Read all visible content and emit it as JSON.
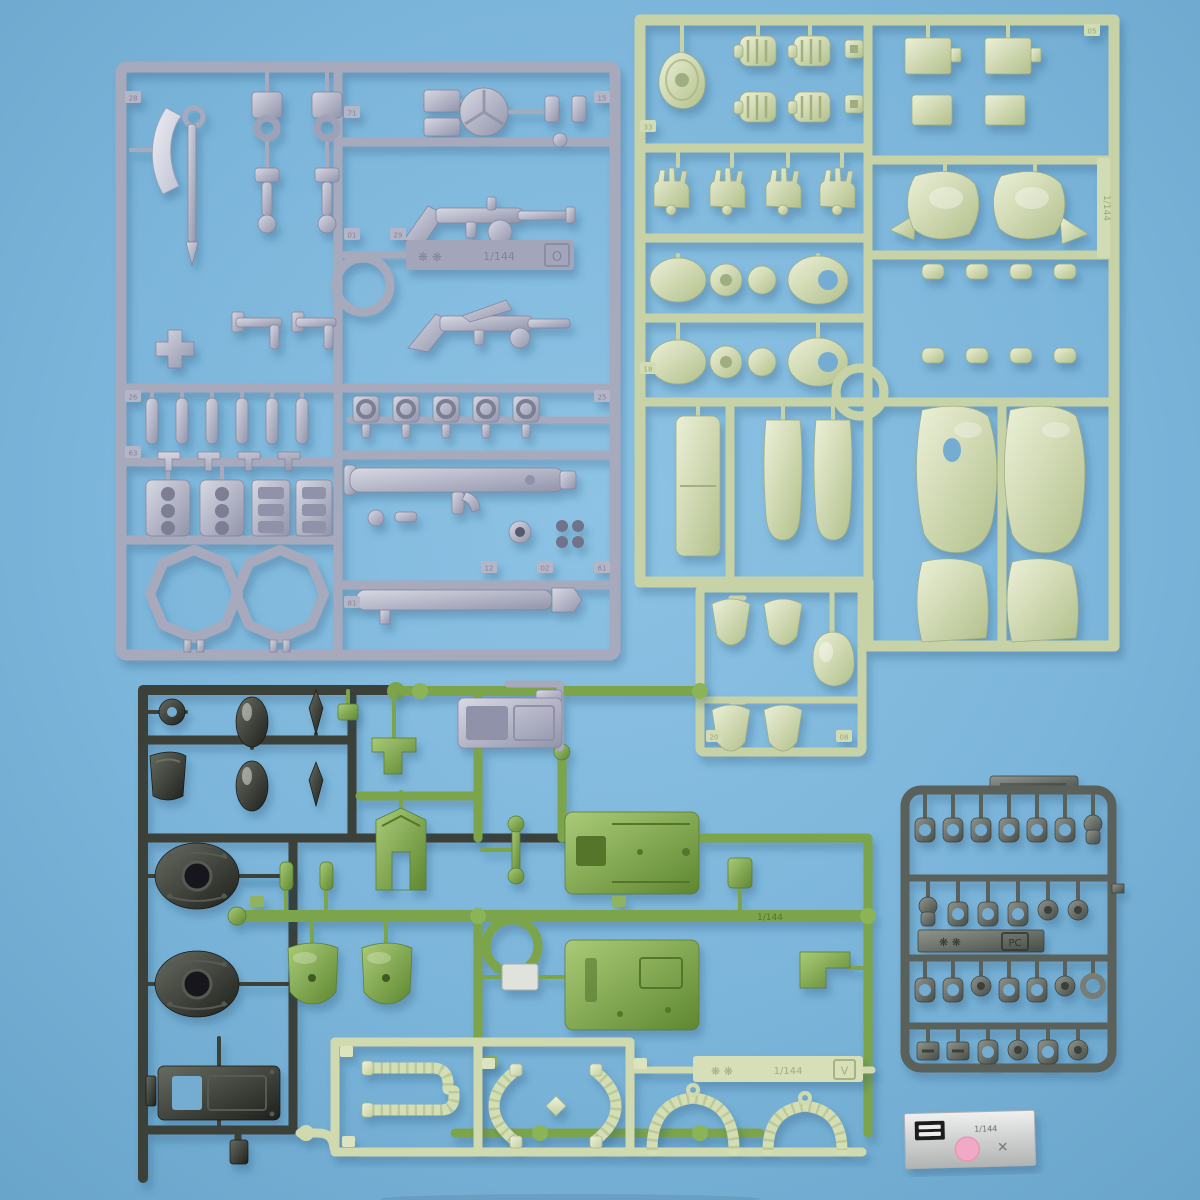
{
  "alt_text": "Photograph of plastic model kit runner sprues (gray weapons, pale sage body armor, dark feet, olive torso, pale power pipes, polycap joints) and a silver foil sticker sheet on a light blue background",
  "colors": {
    "background": "#7cb5da",
    "runner_gray": "#a7a9bd",
    "runner_sage": "#c7d3a6",
    "runner_dark": "#3b3f39",
    "runner_olive": "#7ca44b",
    "runner_pale": "#d0daae",
    "runner_polycap": "#5a605a",
    "sticker_foil": "#d8dad9",
    "mono_eye_pink": "#f2a9c5"
  },
  "runners": {
    "gray": {
      "logo_marks": "❋ ❋",
      "scale_text": "1/144",
      "letter": "O",
      "part_tags": [
        "28",
        "71",
        "15",
        "01",
        "29",
        "26",
        "25",
        "63",
        "12",
        "02",
        "61",
        "81"
      ]
    },
    "sage": {
      "side_tag_text": "1/144",
      "part_tags": [
        "05",
        "33",
        "18",
        "20",
        "08"
      ]
    },
    "olive": {
      "rail_text": "1/144"
    },
    "pale": {
      "logo_marks": "❋ ❋",
      "scale_text": "1/144",
      "letter": "V"
    },
    "polycap": {
      "logo_marks": "❋ ❋",
      "letter": "PC"
    }
  },
  "sticker": {
    "line_text": "1/144"
  }
}
